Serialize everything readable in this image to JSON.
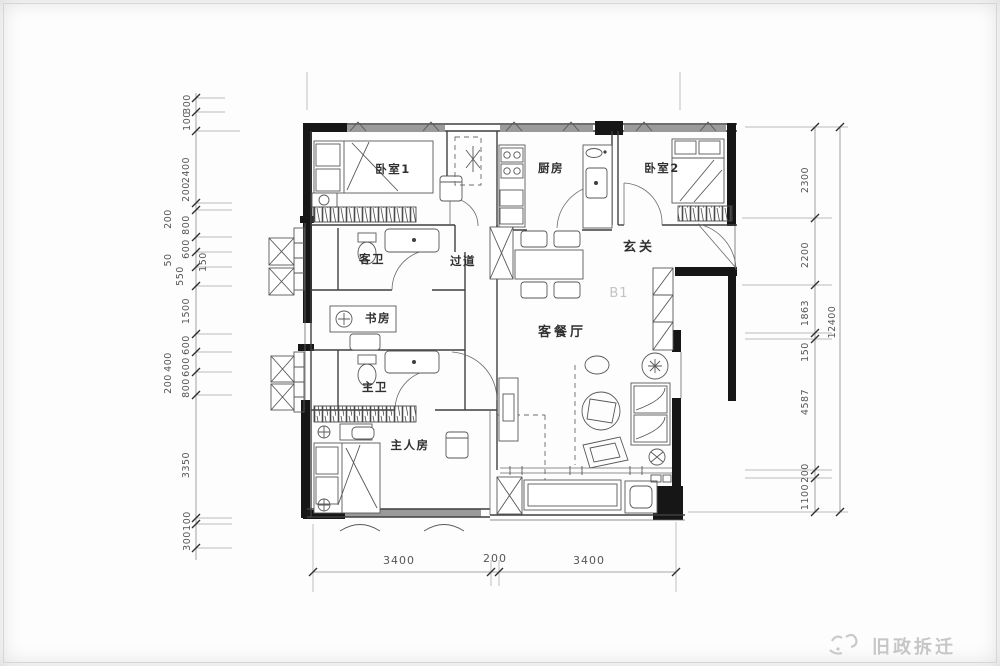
{
  "rooms": {
    "bedroom1": "卧室1",
    "kitchen": "厨房",
    "bedroom2": "卧室2",
    "foyer": "玄关",
    "guest_bath": "客卫",
    "corridor": "过道",
    "study": "书房",
    "living_dining": "客餐厅",
    "master_bath": "主卫",
    "master_bedroom": "主人房",
    "unit_code": "B1"
  },
  "dims": {
    "left": [
      "300",
      "100",
      "2400",
      "200",
      "200",
      "800",
      "600",
      "50",
      "150",
      "550",
      "1500",
      "600",
      "400",
      "600",
      "200",
      "800",
      "3350",
      "100",
      "300"
    ],
    "right": [
      "2300",
      "2200",
      "1863",
      "150",
      "4587",
      "200",
      "1100"
    ],
    "right_total": "12400",
    "bottom": [
      "3400",
      "200",
      "3400"
    ]
  },
  "watermark": {
    "text": "旧政拆迁"
  },
  "colors": {
    "background": "#fdfdfd",
    "wall_fill": "#161616",
    "line": "#3f3f3f",
    "window_strip": "#9a9a9a",
    "dim_text": "#565656",
    "room_text": "#303030",
    "watermark_text": "#c6c6c6",
    "unit_code_text": "#c3c3c3"
  }
}
